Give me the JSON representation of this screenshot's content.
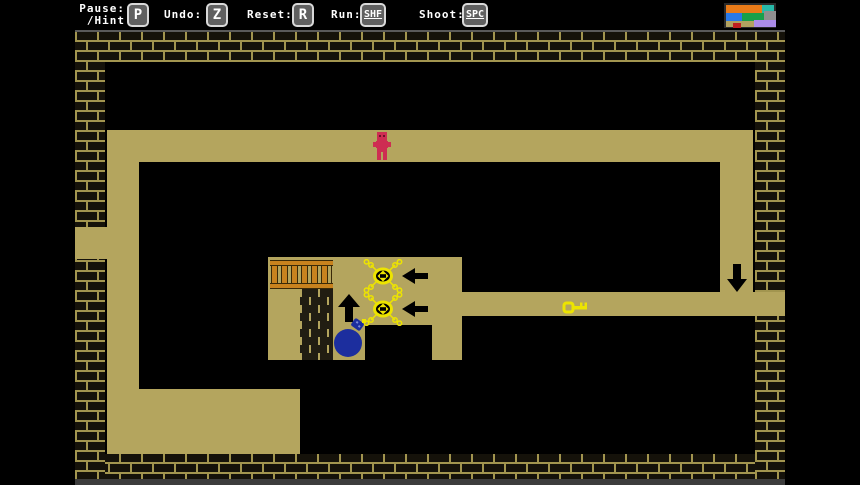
{
  "toolbar": {
    "items": [
      {
        "label_line1": "Pause:",
        "label_line2": "/Hint",
        "key": "P"
      },
      {
        "label": "Undo:",
        "key": "Z"
      },
      {
        "label": "Reset:",
        "key": "R"
      },
      {
        "label": "Run:",
        "key": "SHF"
      },
      {
        "label": "Shoot:",
        "key": "SPC"
      }
    ]
  },
  "minimap": {
    "description": "level overview thumbnail",
    "block_colors": [
      "#e87a18",
      "#28b8a8",
      "#2979e8",
      "#18a04a",
      "#8f8f8f",
      "#b2a260",
      "#c01f1f",
      "#ab8ce8"
    ]
  },
  "game": {
    "entities": [
      {
        "name": "player",
        "color": "#ce2d52"
      },
      {
        "name": "spider-enemy-1",
        "color": "#ede400"
      },
      {
        "name": "spider-enemy-2",
        "color": "#ede400"
      },
      {
        "name": "arrow-left-1",
        "color": "#000000"
      },
      {
        "name": "arrow-left-2",
        "color": "#000000"
      },
      {
        "name": "arrow-up",
        "color": "#000000"
      },
      {
        "name": "arrow-down",
        "color": "#000000"
      },
      {
        "name": "key",
        "color": "#ede400"
      },
      {
        "name": "bomb",
        "color": "#1c2e9e"
      },
      {
        "name": "fence",
        "color": "#c8821e"
      },
      {
        "name": "inner-brick-column"
      }
    ]
  },
  "colors": {
    "path_tan": "#b4a55e",
    "border_mortar": "#a2954f",
    "border_brick": "#15120a",
    "player_red": "#ce2d52",
    "enemy_yellow": "#ede400",
    "bomb_blue": "#1c2e9e",
    "fence_orange": "#c8821e"
  }
}
